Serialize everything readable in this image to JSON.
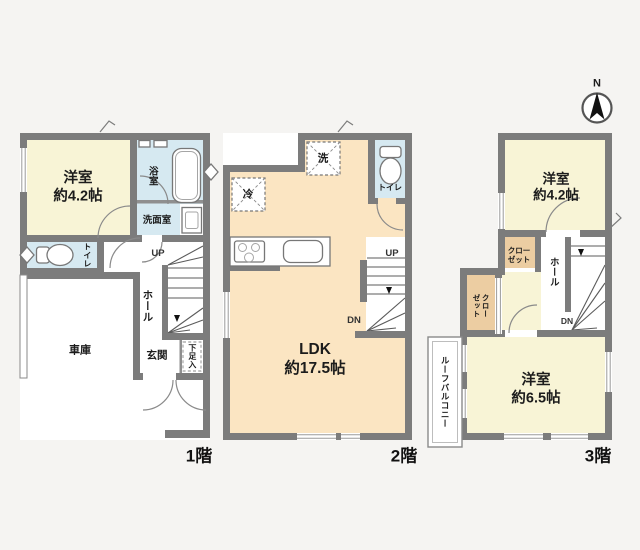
{
  "colors": {
    "wall": "#7c7c7c",
    "room_cream": "#f8f4d6",
    "room_peach": "#fbe5c2",
    "room_blue": "#d6e9f1",
    "closet_tan": "#eccda2",
    "background": "#f5f4f2",
    "text": "#1c1c1c"
  },
  "compass": {
    "north": "N"
  },
  "floor1": {
    "label": "1階",
    "rooms": {
      "western_room": "洋室\n約4.2帖",
      "bathroom": "浴室",
      "washroom": "洗面室",
      "toilet": "トイレ",
      "hall": "ホール",
      "entrance": "玄関",
      "shoe_storage": "下足入",
      "garage": "車庫",
      "stairs_up": "UP"
    }
  },
  "floor2": {
    "label": "2階",
    "rooms": {
      "ldk": "LDK\n約17.5帖",
      "washer_space": "洗",
      "fridge_space": "冷",
      "toilet": "トイレ",
      "stairs_up": "UP",
      "stairs_down": "DN"
    }
  },
  "floor3": {
    "label": "3階",
    "rooms": {
      "western_room_42": "洋室\n約4.2帖",
      "western_room_65": "洋室\n約6.5帖",
      "closet_upper": "クロー\nゼット",
      "closet_lower": "クロー\nゼット",
      "hall": "ホール",
      "stairs_down": "DN",
      "roof_balcony": "ルーフバルコニー"
    }
  }
}
